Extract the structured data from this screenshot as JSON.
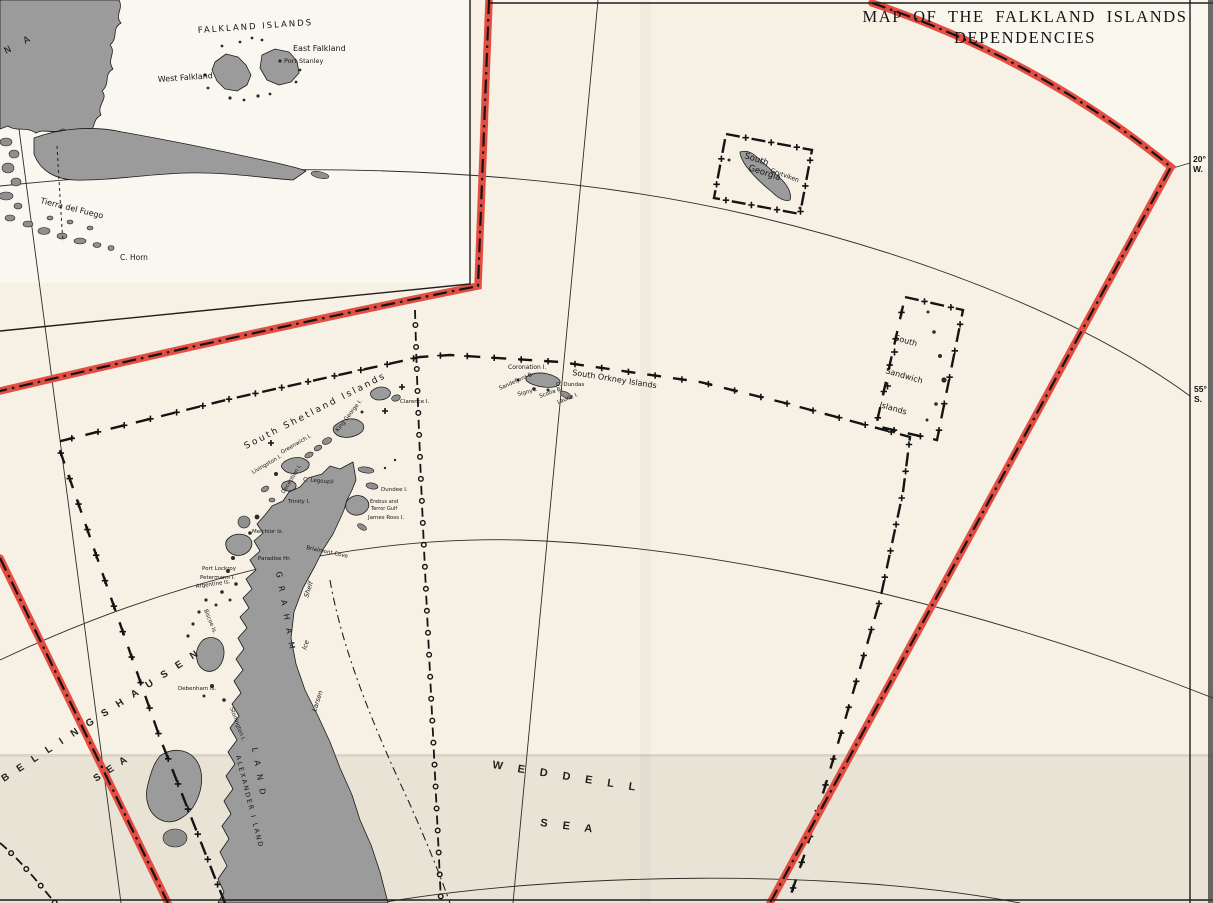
{
  "title": {
    "line1": "MAP OF THE FALKLAND ISLANDS",
    "line2": "DEPENDENCIES"
  },
  "colors": {
    "boundary_red": "#e44d41",
    "land_gray": "#9b9b9b",
    "paper": "#f6f1e4",
    "ink": "#141414"
  },
  "coordinates": {
    "lon_value": "20°",
    "lon_hemisphere": "W.",
    "lat_value": "55°",
    "lat_hemisphere": "S."
  },
  "falkland_islands": {
    "group_label": "FALKLAND ISLANDS",
    "west": "West Falkland",
    "east": "East Falkland",
    "capital": "Port Stanley"
  },
  "south_america": {
    "tierra_del_fuego": "Tierra del Fuego",
    "cape_horn": "C. Horn",
    "mainland_fragment": "N A"
  },
  "south_georgia": {
    "name_line1": "South",
    "name_line2": "Georgia",
    "station": "Grytviken"
  },
  "south_orkney": {
    "group_label": "South Orkney Islands",
    "coronation": "Coronation I.",
    "sandefjord": "Sandefjord B.",
    "signy": "Signy I.",
    "scotia": "Scotia B.",
    "cape": "C. Dundas",
    "laurie": "Laurie I."
  },
  "south_sandwich": {
    "line1": "South",
    "line2": "Sandwich",
    "line3": "Islands"
  },
  "south_shetland": {
    "group_label": "South Shetland Islands",
    "clarence": "Clarence I.",
    "king_george": "King George I.",
    "greenwich": "Greenwich I.",
    "livingston": "Livingston I.",
    "deception": "Deception I."
  },
  "graham_land": {
    "name": "G R A H A M",
    "name2": "L A N D",
    "alexander": "ALEXANDER I LAND",
    "larsen_word1": "Larsen",
    "larsen_word2": "Ice",
    "larsen_word3": "Shelf",
    "legoupil": "C. Legoupil",
    "trinity": "Trinity I.",
    "dundee": "Dundee I.",
    "erebus_line1": "Erebus and",
    "erebus_line2": "Terror Gulf",
    "james_ross": "James Ross I.",
    "brialmont": "Brialmont Cove",
    "paradise": "Paradise Hr.",
    "melchior": "Melchior Is.",
    "port_lockroy": "Port Lockroy",
    "petermann": "Petermann I.",
    "argentine": "Argentine Is.",
    "biscoe": "Biscoe Is.",
    "debenham": "Debenham Is.",
    "stonington": "Stonington I."
  },
  "seas": {
    "bellingshausen": "B E L L I N G S H A U S E N",
    "bellingshausen_sea": "S E A",
    "weddell": "W E D D E L L",
    "weddell_sea": "S E A"
  }
}
